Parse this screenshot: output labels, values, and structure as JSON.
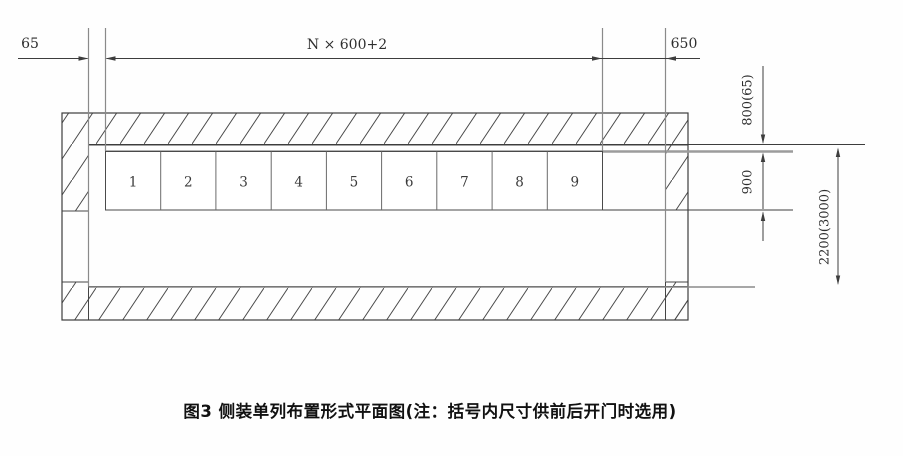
{
  "figure": {
    "caption": "图3 侧装单列布置形式平面图(注：括号内尺寸供前后开门时选用)",
    "top_dims": {
      "left": "65",
      "middle": "N × 600+2",
      "right": "650"
    },
    "right_dims": {
      "upper": "800(65)",
      "middle": "900",
      "lower": "2200(3000)"
    },
    "cells": [
      "1",
      "2",
      "3",
      "4",
      "5",
      "6",
      "7",
      "8",
      "9"
    ]
  }
}
